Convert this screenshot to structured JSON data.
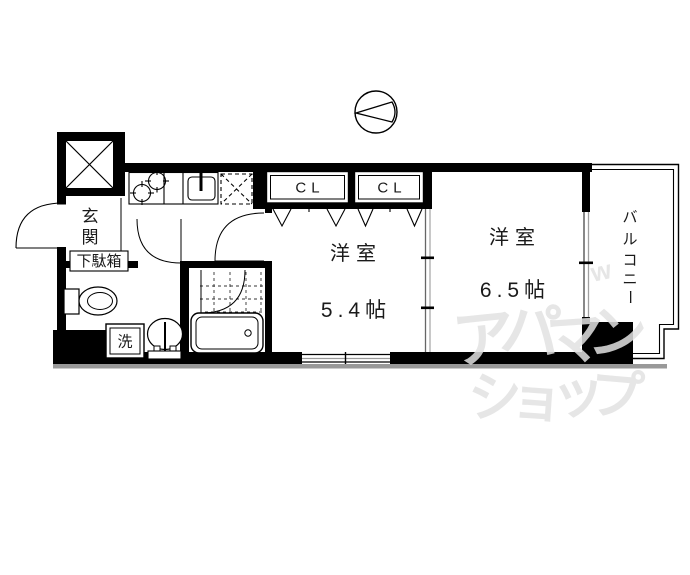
{
  "plan": {
    "entrance": {
      "label": "玄関",
      "chars": [
        "玄",
        "関"
      ]
    },
    "shoe_box": {
      "label": "下駄箱"
    },
    "laundry": {
      "label": "洗"
    },
    "closet_1": {
      "label": "CL"
    },
    "closet_2": {
      "label": "CL"
    },
    "room_1": {
      "type_label": "洋室",
      "size_label": "5.4帖"
    },
    "room_2": {
      "type_label": "洋室",
      "size_label": "6.5帖"
    },
    "balcony": {
      "label": "バルコニー",
      "chars": [
        "バ",
        "ル",
        "コ",
        "ニ",
        "ー"
      ]
    }
  },
  "watermark": {
    "line1": "アパマン",
    "line1_chars": [
      "ア",
      "パ",
      "マ",
      "ン"
    ],
    "line2": "ショップ",
    "line2_chars": [
      "シ",
      "ョ",
      "ッ",
      "プ"
    ],
    "accent": "w",
    "color": "#e2e2e2"
  },
  "colors": {
    "wall": "#000000",
    "window": "#888888",
    "shadow": "#999999",
    "floor": "#ffffff"
  }
}
